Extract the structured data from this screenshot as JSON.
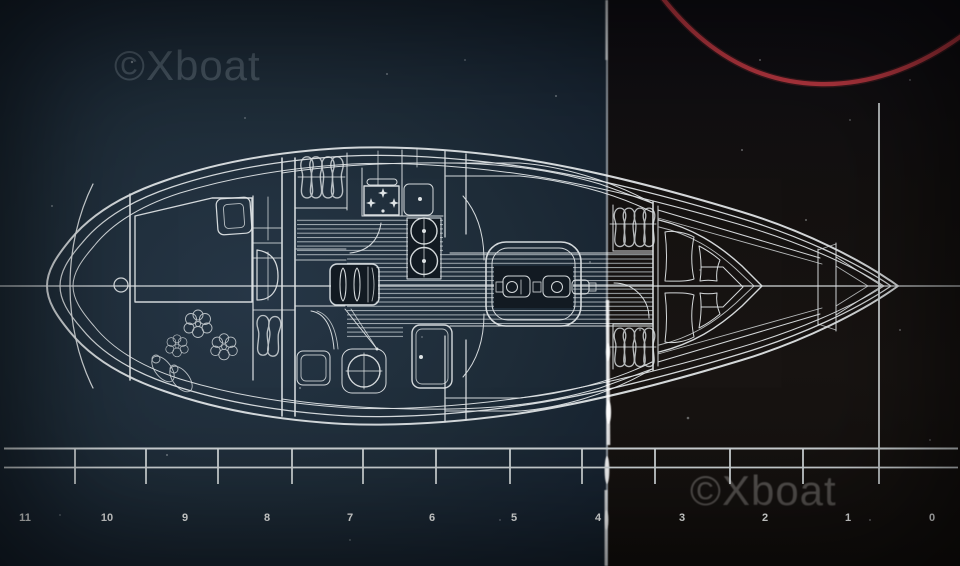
{
  "watermarks": {
    "top_left": "©Xboat",
    "bottom_right": "©Xboat"
  },
  "ruler": {
    "labels": [
      "11",
      "10",
      "9",
      "8",
      "7",
      "6",
      "5",
      "4",
      "3",
      "2",
      "1",
      "0"
    ]
  },
  "colors": {
    "background_left": "#1e2c38",
    "background_right": "#141110",
    "drawing_line": "#dee3e5",
    "red_arc": "#bf3a42",
    "ruler_text": "#eff1f0"
  }
}
